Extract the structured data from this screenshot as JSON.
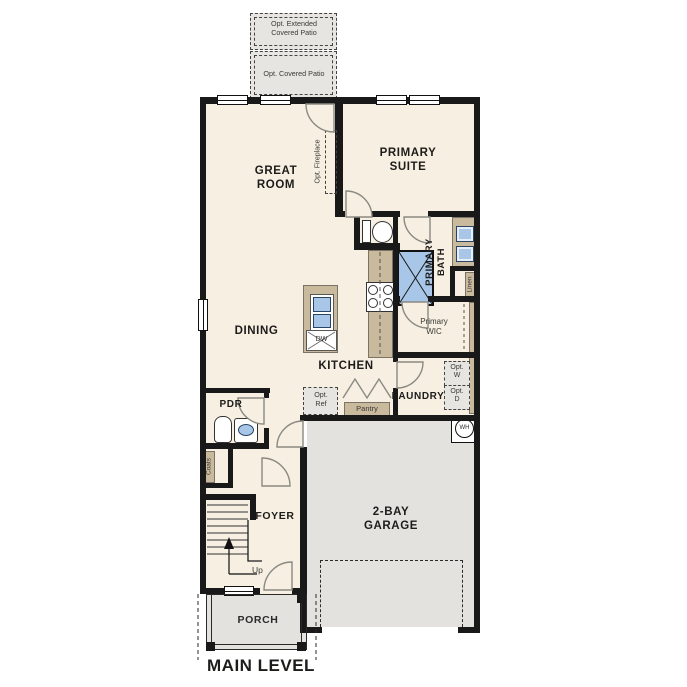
{
  "title": "MAIN LEVEL",
  "colors": {
    "wall": "#191919",
    "floor": "#f6efe2",
    "hardscape": "#e3e2df",
    "patio": "#eae9e5",
    "cabinet": "#c9b99d",
    "fixture_blue": "#a8c7e8",
    "door_arc": "#8a8a82",
    "text": "#1d1c1a"
  },
  "rooms": {
    "great_room": "GREAT ROOM",
    "primary_suite": "PRIMARY SUITE",
    "primary_bath": "PRIMARY BATH",
    "primary_wic": "Primary WIC",
    "dining": "DINING",
    "kitchen": "KITCHEN",
    "laundry": "LAUNDRY",
    "powder": "PDR",
    "foyer": "FOYER",
    "porch": "PORCH",
    "garage": "2-BAY GARAGE"
  },
  "annotations": {
    "opt_extended_patio": "Opt. Extended Covered Patio",
    "opt_covered_patio": "Opt. Covered Patio",
    "opt_fireplace": "Opt. Fireplace",
    "pantry": "Pantry",
    "linen": "Linen",
    "coats": "Coats",
    "opt_ref": "Opt. Ref",
    "opt_washer": "Opt. W",
    "opt_dryer": "Opt. D",
    "dishwasher": "DW",
    "water_heater": "WH",
    "stairs_up": "Up"
  }
}
